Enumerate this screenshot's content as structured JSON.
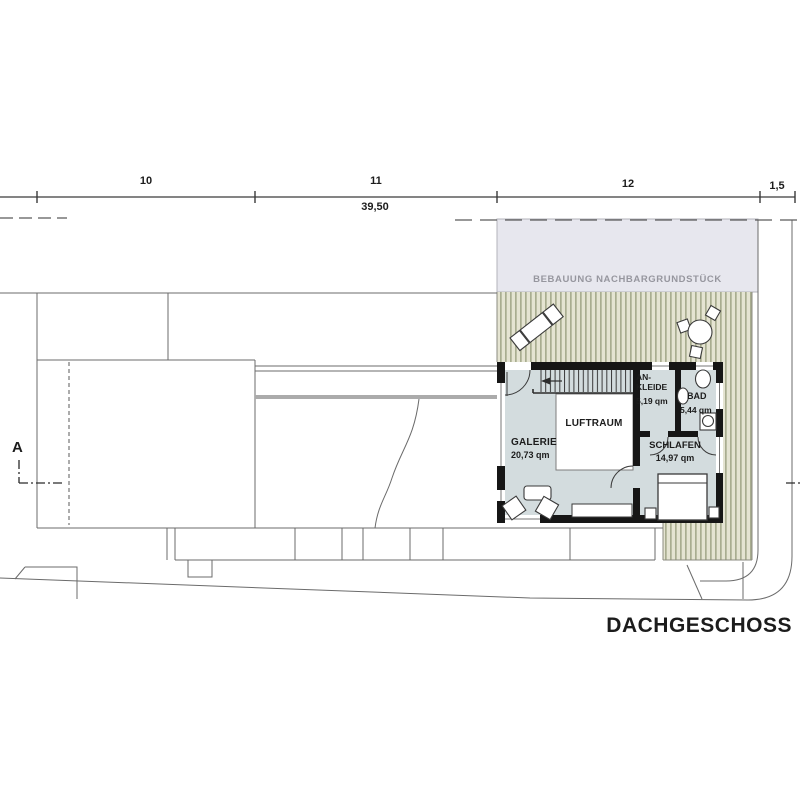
{
  "title": "DACHGESCHOSS",
  "dimension_line": {
    "segments": [
      {
        "label": "10"
      },
      {
        "label": "11"
      },
      {
        "label": "12"
      },
      {
        "label": "1,5"
      }
    ],
    "total": "39,50"
  },
  "section_marker": {
    "label": "A"
  },
  "neighbor_area": {
    "label": "BEBAUUNG NACHBARGRUNDSTÜCK"
  },
  "rooms": {
    "galerie": {
      "name": "GALERIE",
      "area": "20,73 qm"
    },
    "luftraum": {
      "name": "LUFTRAUM"
    },
    "ankleide": {
      "name": "AN-KLEIDE",
      "area": "5,19 qm"
    },
    "bad": {
      "name": "BAD",
      "area": "5,44 qm"
    },
    "schlafen": {
      "name": "SCHLAFEN",
      "area": "14,97 qm"
    }
  },
  "colors": {
    "wall": "#161616",
    "floor": "#d3dcde",
    "hatch_stripe": "#a9ad90",
    "hatch_bg": "#e5e4d2",
    "neighbor_fill": "#e7e7ee",
    "neighbor_text": "#96969e",
    "thin_line": "#6b6b6b"
  }
}
